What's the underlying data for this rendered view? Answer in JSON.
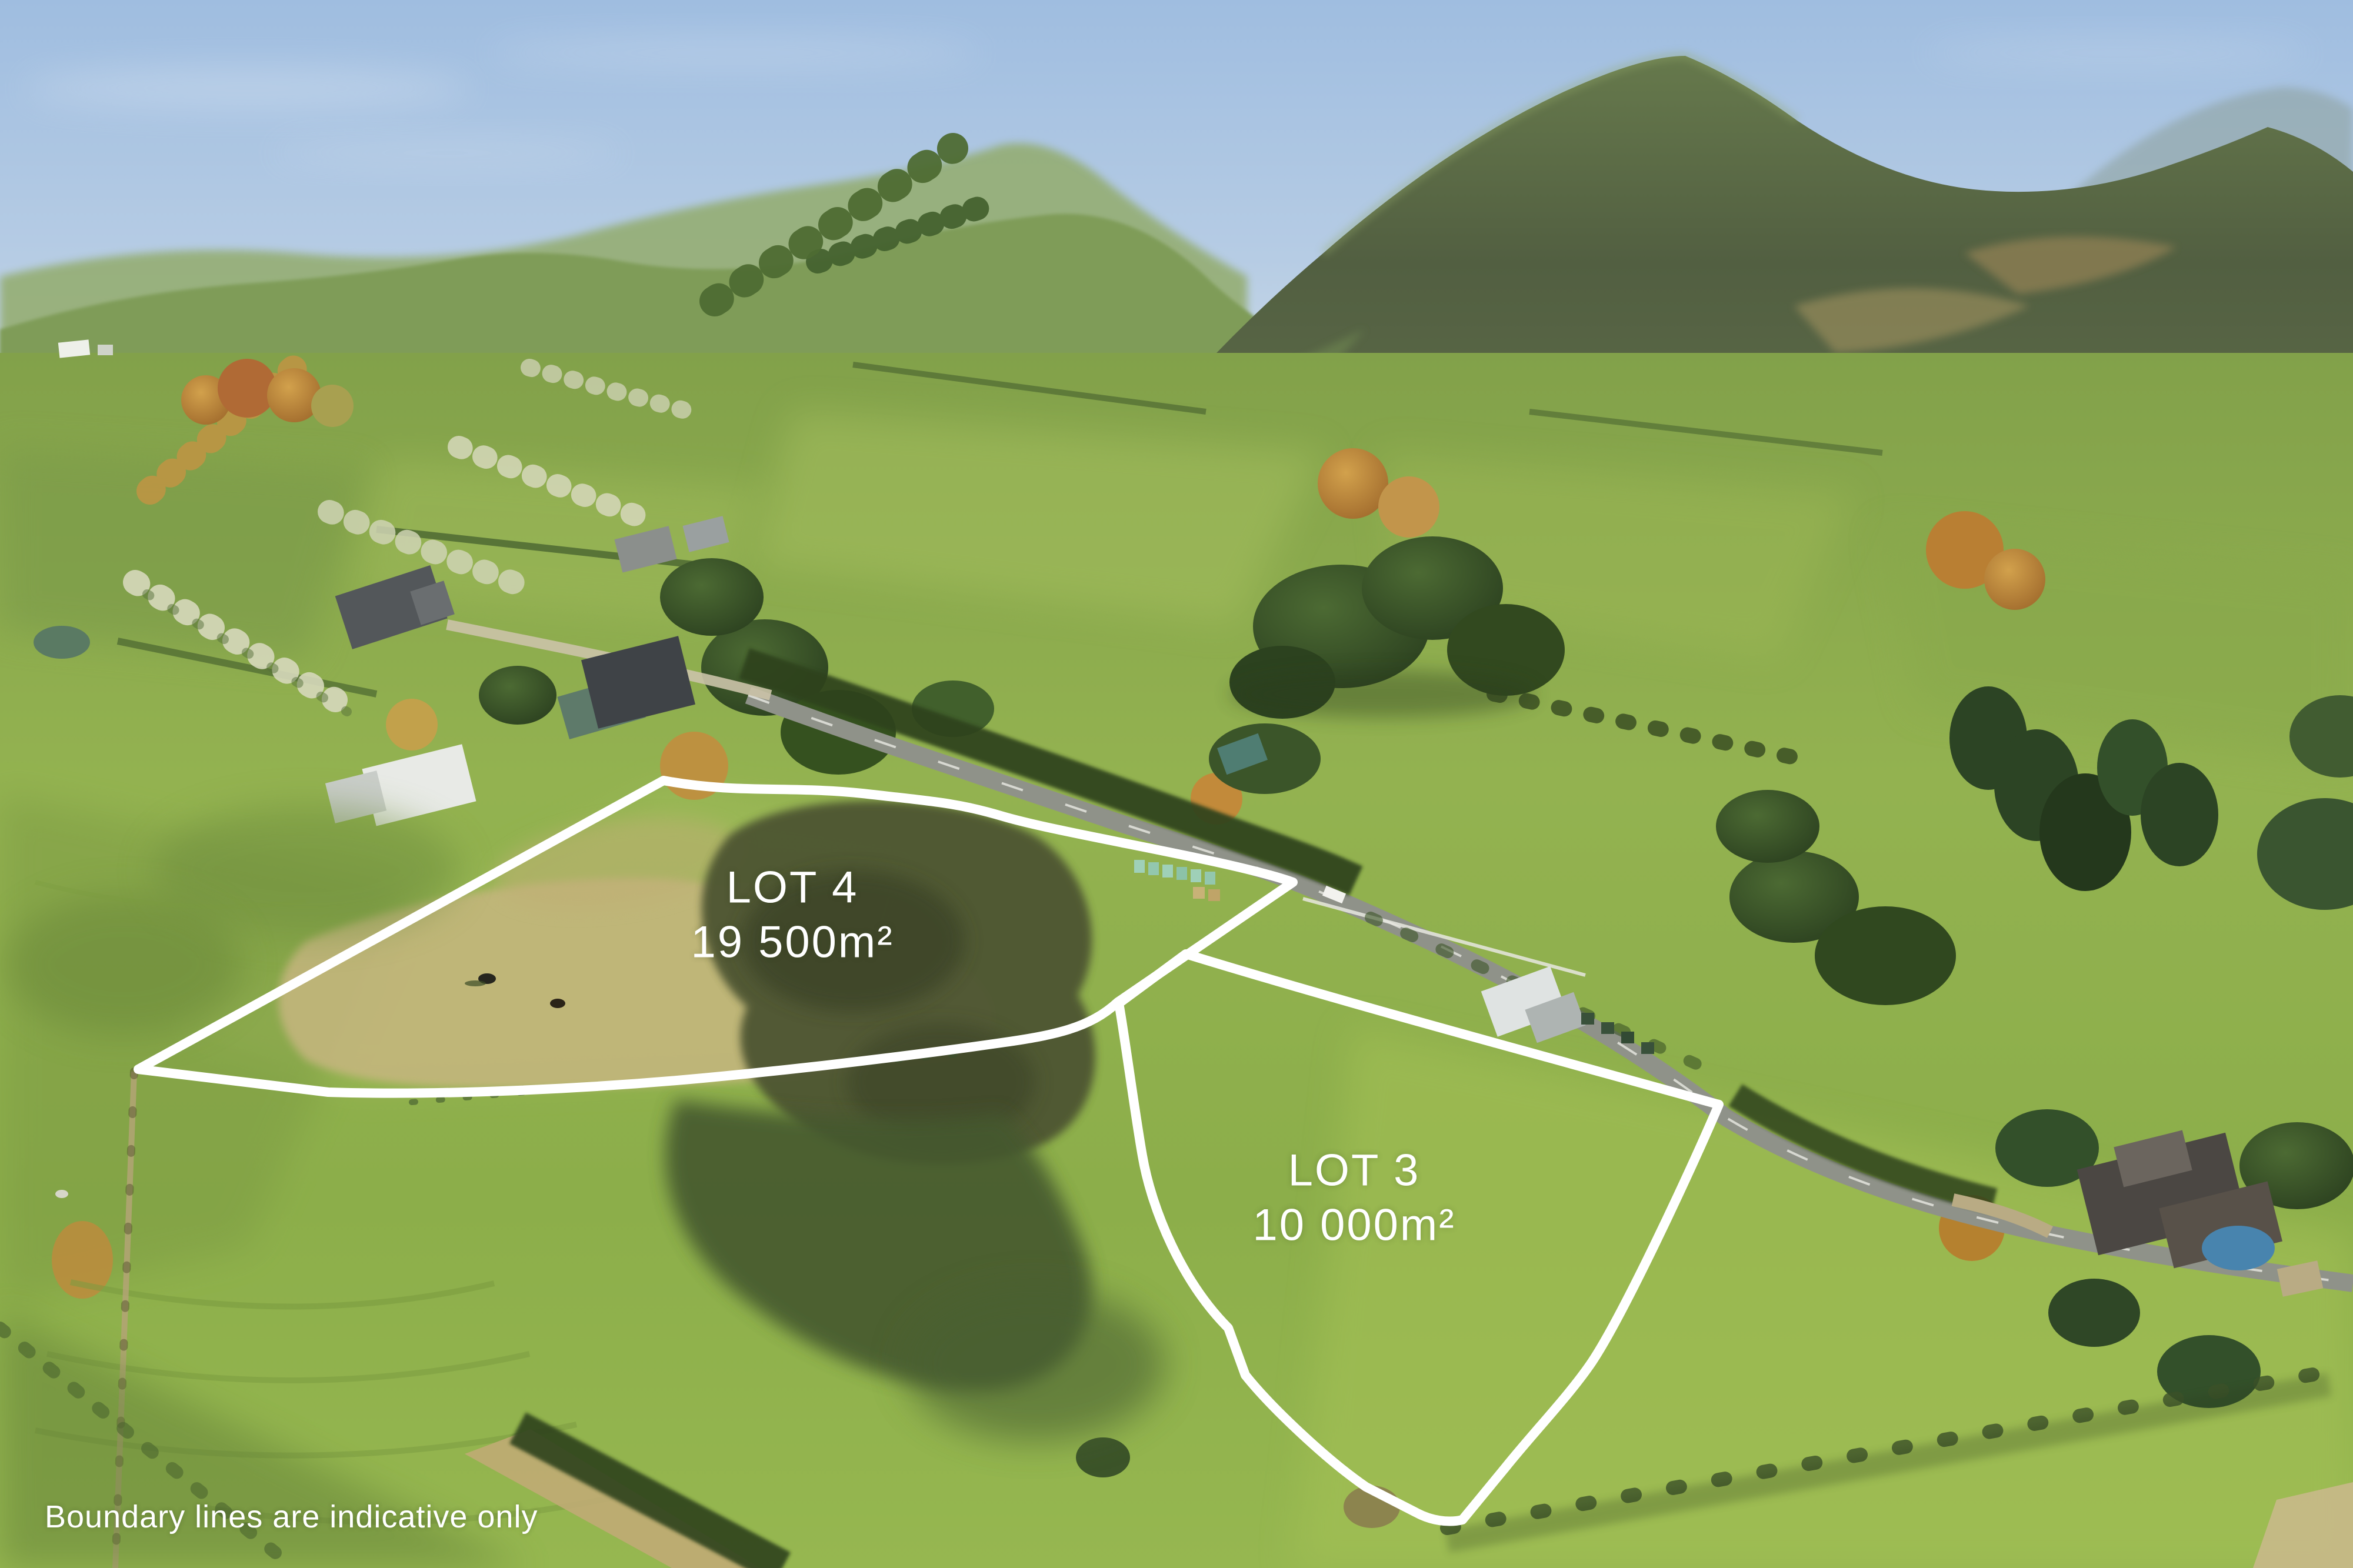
{
  "photo": {
    "kind": "aerial-drone-photo",
    "scene": "Rural lifestyle sections among rolling green farmland, road and forested hills"
  },
  "overlay": {
    "lot4": {
      "name": "LOT 4",
      "area": "19 500m²"
    },
    "lot3": {
      "name": "LOT 3",
      "area": "10 000m²"
    },
    "disclaimer": "Boundary lines are indicative only"
  },
  "colors": {
    "boundary_line": "#ffffff",
    "label_text": "#ffffff",
    "sky_top": "#a3c1e2",
    "sky_horizon": "#d4dfe9",
    "grass_bright": "#a9c155",
    "grass_mid": "#8fb04a",
    "grass_shadow": "#4a5f31",
    "forest_dark": "#47573a",
    "dry_grass": "#c6b67f",
    "autumn_tree": "#b97f33",
    "road": "#90938a"
  }
}
